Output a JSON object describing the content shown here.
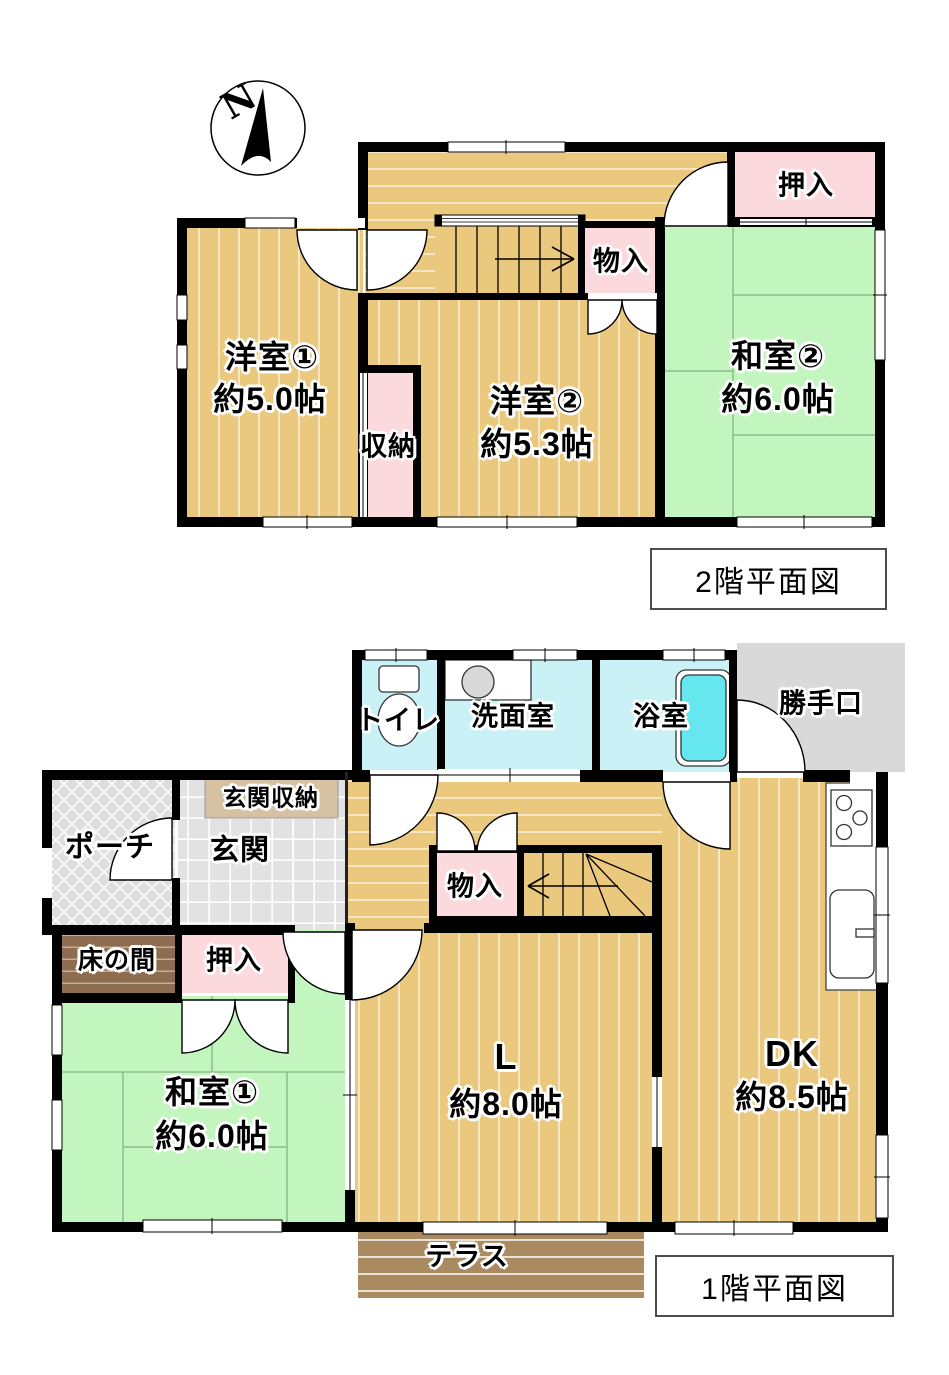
{
  "compass": {
    "north_label": "N"
  },
  "floor2": {
    "title": "2階平面図",
    "rooms": {
      "yoshitsu1": {
        "name": "洋室①",
        "size": "約5.0帖"
      },
      "yoshitsu2": {
        "name": "洋室②",
        "size": "約5.3帖"
      },
      "washitsu2": {
        "name": "和室②",
        "size": "約6.0帖"
      },
      "oshiire": "押入",
      "monoire": "物入",
      "shuno": "収納"
    }
  },
  "floor1": {
    "title": "1階平面図",
    "rooms": {
      "toilet": "トイレ",
      "washroom": "洗面室",
      "bathroom": "浴室",
      "backdoor": "勝手口",
      "entrance": "玄関",
      "entrance_storage": "玄関収納",
      "porch": "ポーチ",
      "monoire": "物入",
      "oshiire": "押入",
      "tokonoma": "床の間",
      "washitsu1": {
        "name": "和室①",
        "size": "約6.0帖"
      },
      "living": {
        "name": "L",
        "size": "約8.0帖"
      },
      "dk": {
        "name": "DK",
        "size": "約8.5帖"
      },
      "terrace": "テラス"
    }
  },
  "colors": {
    "wood_floor": "#eac87d",
    "tatami_green": "#c3f6bf",
    "closet_pink": "#fbd9dd",
    "wet_area_cyan": "#c9f1f6",
    "bathtub_cyan": "#66e6ef",
    "concrete_gray": "#d9d9d9",
    "terrace_brown": "#a98a61",
    "tokonoma_brown": "#8e6c50",
    "entrance_storage_tan": "#d6c2a2",
    "wall_black": "#000000"
  }
}
